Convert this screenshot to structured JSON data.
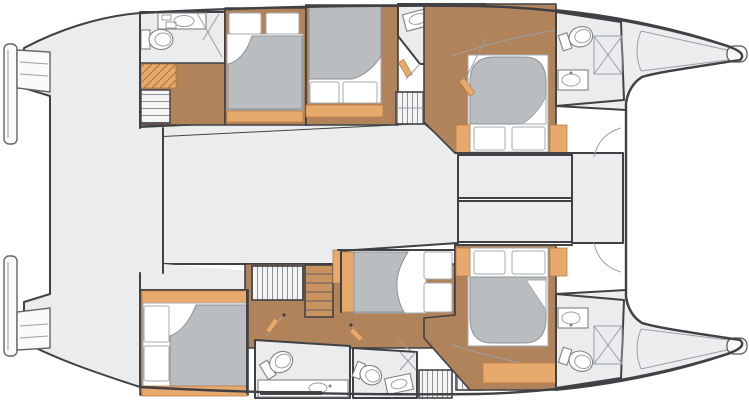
{
  "plan": {
    "title": "Catamaran sailing yacht interior deck plan, 6 cabins, twin hulls, bows to the right",
    "orientation": {
      "bow": "right",
      "stern": "left"
    },
    "cabin_count": 6,
    "bathroom_count": 5
  },
  "colors": {
    "background": "#ffffff",
    "deck_gray": "#ebecee",
    "cabin_floor_wood": "#b1835b",
    "accent_tan": "#e8a96c",
    "mattress_gray": "#b9bdc0",
    "wall_dark": "#404145",
    "thin_line": "#9aa0a5"
  },
  "exterior": {
    "features": [
      "port swim platform",
      "starboard swim platform",
      "transom steps",
      "aft cockpit deck",
      "twin tapered bows with bow fittings"
    ]
  },
  "center_section": {
    "rooms": [
      {
        "name": "aft cockpit",
        "fixtures": []
      },
      {
        "name": "saloon",
        "fixtures": []
      },
      {
        "name": "forward compartments",
        "fixtures": [
          "two storage cells",
          "forward locker with door-swing arcs"
        ]
      }
    ]
  },
  "upper_hull": {
    "rooms": [
      {
        "name": "aft bathroom",
        "fixtures": [
          "toilet",
          "sink counter",
          "shower glass"
        ]
      },
      {
        "name": "companionway landing",
        "fixtures": [
          "stairs",
          "drawer unit"
        ]
      },
      {
        "name": "aft cabin",
        "fixtures": [
          "double bed with two pillows and folded duvet"
        ]
      },
      {
        "name": "mid cabin",
        "fixtures": [
          "double bed with two pillows and folded duvet"
        ]
      },
      {
        "name": "mid bathroom",
        "fixtures": [
          "toilet",
          "sink",
          "hanging locker"
        ]
      },
      {
        "name": "forward cabin",
        "fixtures": [
          "island double bed",
          "companionway steps"
        ]
      },
      {
        "name": "forward bathroom",
        "fixtures": [
          "toilet",
          "sink",
          "shower tray"
        ]
      }
    ]
  },
  "lower_hull": {
    "rooms": [
      {
        "name": "aft cabin",
        "fixtures": [
          "double bed with two pillows and folded duvet"
        ]
      },
      {
        "name": "hanging wardrobe",
        "fixtures": [
          "louvered locker"
        ]
      },
      {
        "name": "companionway steps",
        "fixtures": [
          "ladder steps"
        ]
      },
      {
        "name": "mid cabin",
        "fixtures": [
          "double bed with two pillows and folded duvet"
        ]
      },
      {
        "name": "corridor",
        "fixtures": [
          "cabin doors"
        ]
      },
      {
        "name": "aft bathroom",
        "fixtures": [
          "toilet",
          "sink counter"
        ]
      },
      {
        "name": "mid bathroom",
        "fixtures": [
          "toilet",
          "sink",
          "shower glass"
        ]
      },
      {
        "name": "forward cabin",
        "fixtures": [
          "island double bed",
          "louvered lockers"
        ]
      },
      {
        "name": "forward bathroom",
        "fixtures": [
          "toilet",
          "sink",
          "shower tray"
        ]
      }
    ]
  }
}
